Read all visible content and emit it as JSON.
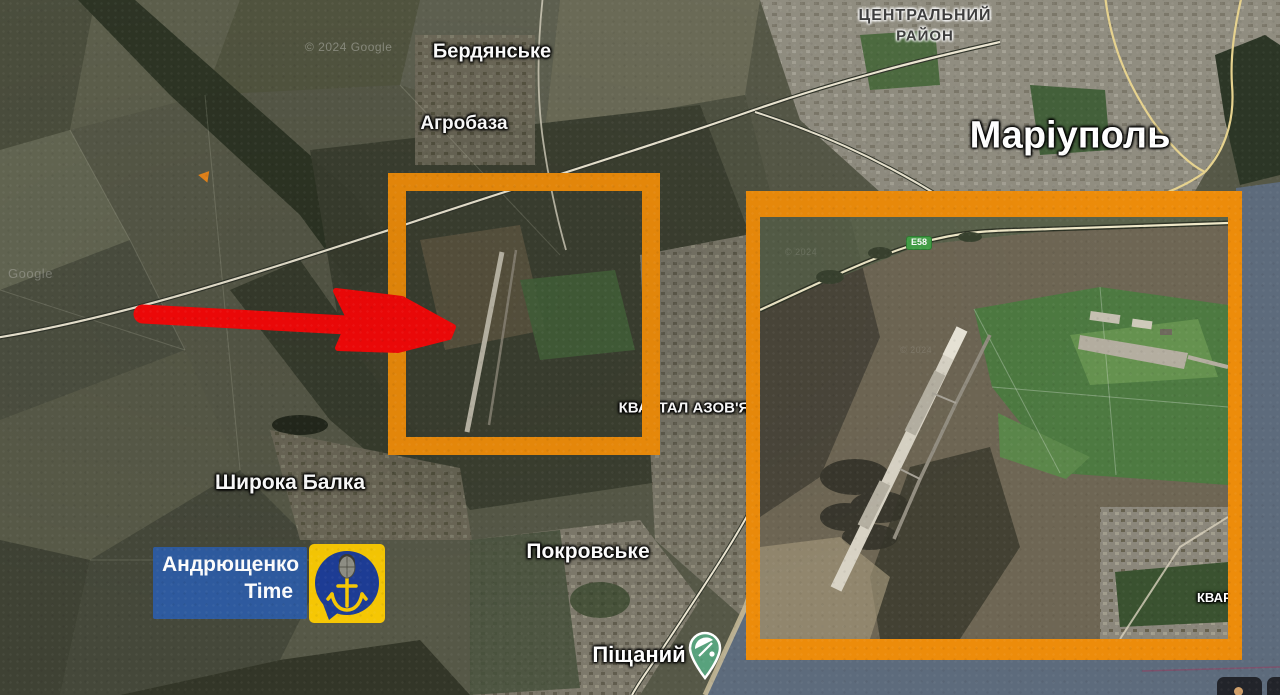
{
  "map": {
    "labels": {
      "berdianske": "Бердянське",
      "agrobaza": "Агробаза",
      "central_district_line1": "ЦЕНТРАЛЬНИЙ",
      "central_district_line2": "РАЙОН",
      "mariupol": "Маріуполь",
      "kvartal_azovia": "КВАРТАЛ АЗОВ'Я",
      "shyroka_balka": "Широка Балка",
      "pokrovske": "Покровське",
      "pishchanyi": "Піщаний",
      "kvartal_clipped": "КВАРТАЛ"
    },
    "road_badge": "E58",
    "watermarks": {
      "copyright_top": "© 2024 Google",
      "google_left": "Google",
      "inset_faint": "© 2024"
    }
  },
  "annotations": {
    "highlight_color": "#ED8C0A",
    "arrow_color": "#F90808"
  },
  "logo": {
    "line1": "Андрющенко",
    "line2": "Time",
    "panel_blue": "#2D5DA9",
    "badge_yellow": "#F7C804",
    "circle_blue": "#1D3D96"
  },
  "poi": {
    "pin_color": "#58A27D",
    "icon": "beach-umbrella-icon"
  }
}
